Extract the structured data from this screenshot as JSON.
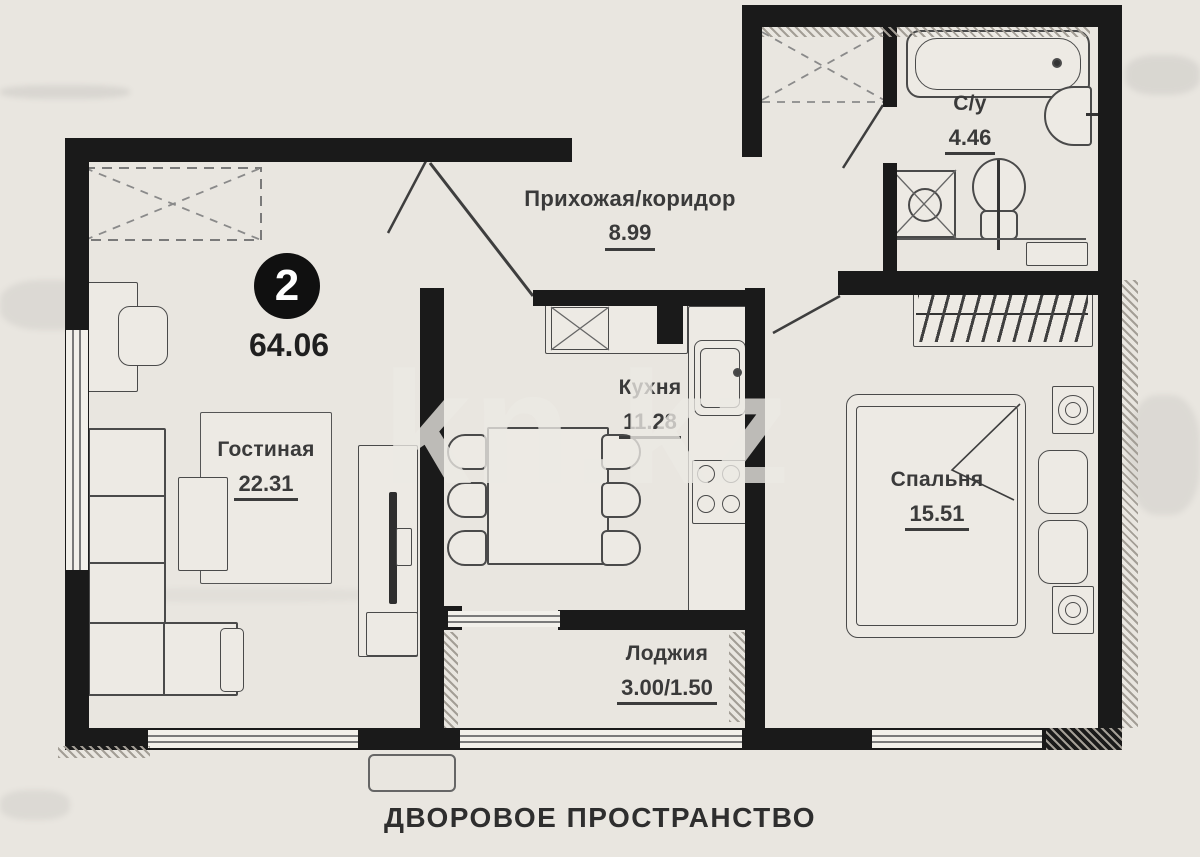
{
  "plan": {
    "unit_badge": "2",
    "total_area": "64.06",
    "rooms": {
      "hallway": {
        "name": "Прихожая/коридор",
        "area": "8.99"
      },
      "bathroom": {
        "name": "С/у",
        "area": "4.46"
      },
      "living": {
        "name": "Гостиная",
        "area": "22.31"
      },
      "kitchen": {
        "name": "Кухня",
        "area": "11.28"
      },
      "bedroom": {
        "name": "Спальня",
        "area": "15.51"
      },
      "loggia": {
        "name": "Лоджия",
        "area": "3.00/1.50"
      }
    },
    "caption": "ДВОРОВОЕ ПРОСТРАНСТВО",
    "watermark": "kn.kz",
    "colors": {
      "wall": "#1a1a1a",
      "paper": "#e9e6e0",
      "line": "#3e3e3e"
    }
  }
}
